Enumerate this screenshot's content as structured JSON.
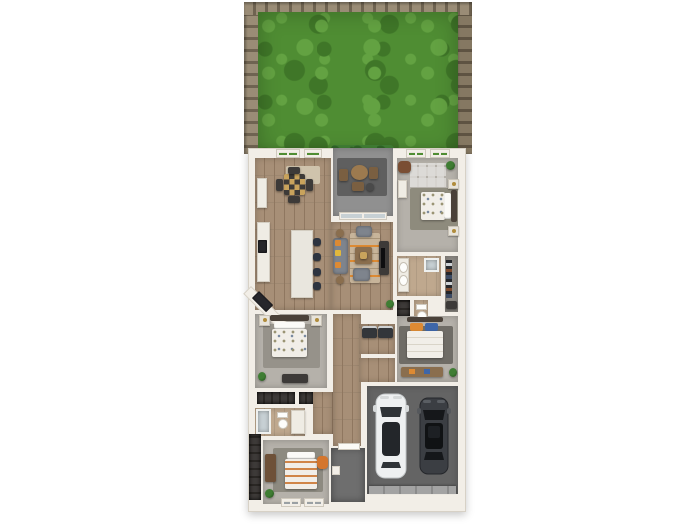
{
  "scene": {
    "type": "3d-floor-plan-render",
    "description": "Top-down 3D render of a single-story home with fenced backyard, covered patio, open kitchen-living-dining area, four bedrooms, two bathrooms, walk-in closet, laundry, front porch, and a two-car garage containing a white SUV and a dark sedan.",
    "background": "#ffffff"
  },
  "colors": {
    "bg": "#ffffff",
    "wall": "#f2eee7",
    "wall-edge": "#d7d1c6",
    "wood": "#a78f77",
    "wood-line": "#8f7760",
    "tile": "#bfa88e",
    "carpet": "#b5b1aa",
    "grass": "#4f8d33",
    "grass-dark": "#3f7628",
    "grass-light": "#63a242",
    "fence": "#9a8c76",
    "fence-post": "#6f6351",
    "concrete": "#909090",
    "garage": "#646464",
    "garage-door": "#a3a3a3",
    "porch": "#6e6e6e",
    "rug-beige": "#cfc3ac",
    "rug-living": "#c7b49a",
    "rug-gray": "#96928a",
    "rug-dark": "#6f6c66",
    "rug-olive": "#8e8b7d",
    "sofa": "#7e848d",
    "orange": "#dd8a33",
    "yellow": "#e2b83c",
    "blue": "#3e66a8",
    "navy": "#2d3440",
    "furn-wood": "#8a6e4e",
    "furn-dark": "#3d3a38",
    "white-furn": "#efece4",
    "marble": "#e9e6de",
    "appliance": "#26262b",
    "duvet": "#f1eee8",
    "headboard": "#4a4139",
    "plant": "#3f7d33",
    "plant-dark": "#2f6326",
    "car-white": "#eef0f1",
    "car-dark": "#3b3e43",
    "glass": "#c7d0d4"
  },
  "rooms": [
    {
      "name": "backyard",
      "floor": "grass",
      "features": [
        "wood privacy fence left/top/right"
      ]
    },
    {
      "name": "dining-room",
      "floor": "wood",
      "furniture": [
        "square table",
        "4 chairs",
        "beige rug",
        "sideboard"
      ]
    },
    {
      "name": "covered-patio",
      "floor": "concrete",
      "furniture": [
        "round table",
        "3 chairs",
        "outdoor rug"
      ]
    },
    {
      "name": "primary-bedroom",
      "floor": "carpet",
      "furniture": [
        "bed",
        "2 nightstands",
        "armchair",
        "dresser",
        "plant"
      ]
    },
    {
      "name": "kitchen",
      "floor": "wood",
      "furniture": [
        "wall counter",
        "cooktop",
        "corner fridge",
        "island",
        "4 stools"
      ]
    },
    {
      "name": "living-room",
      "floor": "wood",
      "furniture": [
        "sofa",
        "2 armchairs",
        "coffee table",
        "tv-console",
        "striped rug"
      ]
    },
    {
      "name": "primary-bathroom",
      "floor": "tile",
      "furniture": [
        "double vanity",
        "shower"
      ]
    },
    {
      "name": "walk-in-closet",
      "floor": "carpet",
      "furniture": [
        "clothes rack",
        "shoe shelf"
      ]
    },
    {
      "name": "toilet-room",
      "floor": "tile",
      "furniture": [
        "toilet"
      ]
    },
    {
      "name": "linen-closet",
      "floor": "n/a",
      "furniture": [
        "shelves"
      ]
    },
    {
      "name": "laundry-room",
      "floor": "wood",
      "furniture": [
        "washer-dryer"
      ]
    },
    {
      "name": "hallway",
      "floor": "wood"
    },
    {
      "name": "bedroom-2",
      "floor": "carpet",
      "furniture": [
        "bed",
        "2 nightstands",
        "dresser",
        "plant",
        "closet shelves"
      ]
    },
    {
      "name": "bathroom-2",
      "floor": "wood",
      "furniture": [
        "shower",
        "toilet",
        "vanity"
      ]
    },
    {
      "name": "bedroom-3",
      "floor": "carpet",
      "furniture": [
        "bed with orange and blue pillows",
        "dresser",
        "plant"
      ]
    },
    {
      "name": "bedroom-4",
      "floor": "carpet",
      "furniture": [
        "striped bed",
        "dresser",
        "orange chair",
        "plant"
      ]
    },
    {
      "name": "hall-closet",
      "floor": "n/a",
      "furniture": [
        "shelves"
      ]
    },
    {
      "name": "foyer",
      "floor": "wood"
    },
    {
      "name": "front-porch",
      "floor": "concrete-dark"
    },
    {
      "name": "garage",
      "floor": "concrete-dark",
      "features": [
        "garage door at bottom"
      ]
    }
  ],
  "vehicles": [
    {
      "name": "white-suv",
      "color": "#eef0f1",
      "position": "garage-left"
    },
    {
      "name": "dark-sedan",
      "color": "#3b3e43",
      "position": "garage-right"
    }
  ]
}
